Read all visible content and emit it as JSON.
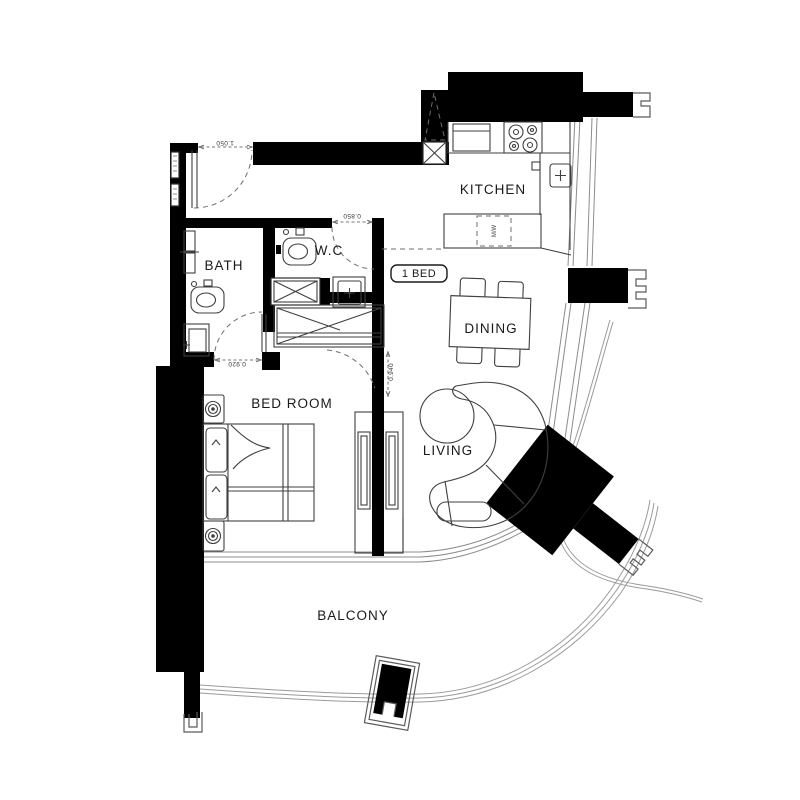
{
  "plan": {
    "unit_badge": "1 BED",
    "rooms": {
      "kitchen": "KITCHEN",
      "bath": "BATH",
      "wc": "W.C",
      "dining": "DINING",
      "living": "LIVING",
      "bedroom": "BED ROOM",
      "balcony": "BALCONY"
    },
    "dimensions": {
      "entry_door": "1.050",
      "wc_door": "0.850",
      "bath_door": "0.920",
      "bedroom_door": "0.940"
    },
    "appliances": {
      "microwave": "M/W"
    },
    "colors": {
      "wall": "#000000",
      "line": "#3f3f3f",
      "thin_line": "#8c8c8c",
      "background": "#ffffff",
      "text": "#1a1a1a"
    }
  }
}
